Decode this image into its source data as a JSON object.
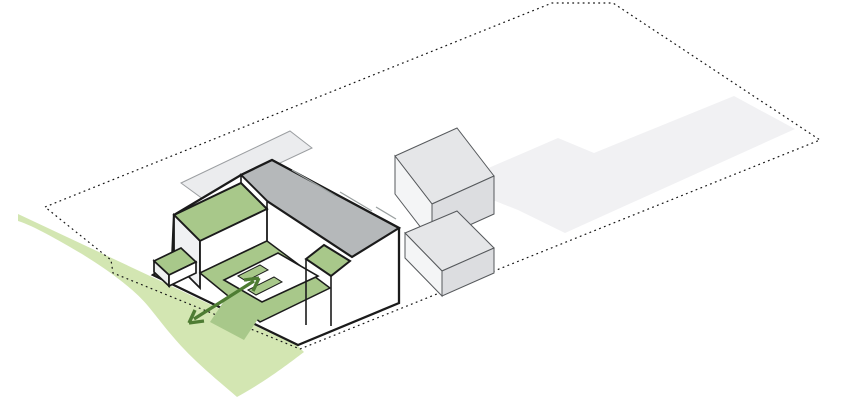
{
  "diagram": {
    "name": "architectural-site-axonometric-diagram",
    "canvas": {
      "width": 853,
      "height": 400
    },
    "palette": {
      "background": "#ffffff",
      "outline_heavy": "#1b1b1b",
      "outline_thin": "#56595c",
      "plate_fill": "#ebecee",
      "plate_stroke": "#9b9ea1",
      "ghost_fill": "#f1f1f3",
      "gray_roof": "#b5b8ba",
      "green_roof": "#a8c88a",
      "landscape_green": "#cfe4ab",
      "arrow_green": "#4e7c33",
      "wall_white": "#ffffff",
      "wall_shaded": "#f0f1f3"
    },
    "legend": {
      "site_boundary": "dotted property line",
      "ghost_future_footprint": "future phase footprint (flat light gray)",
      "green_roofs": "vegetated roofs and courtyard",
      "landscape_green": "landscape connection at south-west",
      "connection_arrow": "double-headed arrow linking courtyard and landscape"
    },
    "shapes": [
      {
        "name": "ground-plate",
        "points": [
          [
            181,
            183
          ],
          [
            290,
            131
          ],
          [
            312,
            148
          ],
          [
            203,
            199
          ]
        ],
        "fill": "#ebecee",
        "stroke": "#9b9ea1",
        "width": 1
      },
      {
        "name": "ghost-future-footprint",
        "points": [
          [
            470,
            176
          ],
          [
            558,
            138
          ],
          [
            594,
            153
          ],
          [
            734,
            96
          ],
          [
            795,
            129
          ],
          [
            565,
            233
          ],
          [
            518,
            210
          ],
          [
            470,
            191
          ]
        ],
        "fill": "#f1f1f3"
      },
      {
        "name": "landscape-green",
        "d": "M18,214 L150,276 L298,346 L304,352 C292,361 268,380 237,397 C222,384 200,366 184,349 C168,332 158,318 148,306 C134,289 108,270 82,254 C58,240 34,226 18,221 Z",
        "fill": "#cfe4ab",
        "opacity": 0.92
      },
      {
        "name": "site-boundary",
        "points": [
          [
            45,
            207
          ],
          [
            552,
            3
          ],
          [
            613,
            3
          ],
          [
            820,
            140
          ],
          [
            300,
            349
          ],
          [
            113,
            273
          ],
          [
            111,
            260
          ]
        ],
        "fill": "none",
        "stroke": "#161616",
        "width": 1.2,
        "dash": "1.8 3.4"
      },
      {
        "name": "annex-upper-top",
        "points": [
          [
            395,
            156
          ],
          [
            457,
            128
          ],
          [
            494,
            176
          ],
          [
            432,
            204
          ]
        ],
        "fill": "#e5e6e8",
        "stroke": "#56595c",
        "width": 1
      },
      {
        "name": "annex-upper-left-face",
        "points": [
          [
            395,
            156
          ],
          [
            432,
            204
          ],
          [
            432,
            242
          ],
          [
            395,
            194
          ]
        ],
        "fill": "#f4f5f6",
        "stroke": "#56595c",
        "width": 1
      },
      {
        "name": "annex-upper-front-face",
        "points": [
          [
            432,
            204
          ],
          [
            494,
            176
          ],
          [
            494,
            214
          ],
          [
            432,
            242
          ]
        ],
        "fill": "#dcdde0",
        "stroke": "#56595c",
        "width": 1
      },
      {
        "name": "annex-lower-top",
        "points": [
          [
            405,
            233
          ],
          [
            457,
            211
          ],
          [
            494,
            248
          ],
          [
            442,
            271
          ]
        ],
        "fill": "#e5e6e8",
        "stroke": "#56595c",
        "width": 1
      },
      {
        "name": "annex-lower-left-face",
        "points": [
          [
            405,
            233
          ],
          [
            442,
            271
          ],
          [
            442,
            296
          ],
          [
            405,
            258
          ]
        ],
        "fill": "#f4f5f6",
        "stroke": "#56595c",
        "width": 1
      },
      {
        "name": "annex-lower-front-face",
        "points": [
          [
            442,
            271
          ],
          [
            494,
            248
          ],
          [
            494,
            273
          ],
          [
            442,
            296
          ]
        ],
        "fill": "#dcdde0",
        "stroke": "#56595c",
        "width": 1
      },
      {
        "name": "building-silhouette",
        "points": [
          [
            174,
            215
          ],
          [
            241,
            175
          ],
          [
            272,
            160
          ],
          [
            399,
            228
          ],
          [
            399,
            303
          ],
          [
            298,
            345
          ],
          [
            153,
            275
          ],
          [
            172,
            262
          ]
        ],
        "fill": "#ffffff",
        "stroke": "#1b1b1b",
        "width": 2.3
      },
      {
        "name": "gray-bar-roof",
        "points": [
          [
            241,
            175
          ],
          [
            272,
            160
          ],
          [
            399,
            228
          ],
          [
            352,
            257
          ],
          [
            267,
            201
          ]
        ],
        "fill": "#b5b8ba",
        "stroke": "#1b1b1b",
        "width": 2.2
      },
      {
        "name": "bar-end-wall-strip",
        "points": [
          [
            241,
            175
          ],
          [
            267,
            201
          ],
          [
            267,
            209
          ],
          [
            241,
            183
          ]
        ],
        "fill": "#ffffff",
        "stroke": "#1b1b1b",
        "width": 1.6
      },
      {
        "name": "left-wing-green-roof",
        "points": [
          [
            174,
            215
          ],
          [
            241,
            183
          ],
          [
            267,
            209
          ],
          [
            200,
            241
          ]
        ],
        "fill": "#a8c88a",
        "stroke": "#1b1b1b",
        "width": 2
      },
      {
        "name": "left-wing-west-face",
        "points": [
          [
            174,
            215
          ],
          [
            200,
            241
          ],
          [
            200,
            288
          ],
          [
            174,
            262
          ]
        ],
        "fill": "#f0f1f3",
        "stroke": "#1b1b1b",
        "width": 1.8
      },
      {
        "name": "left-wing-se-face",
        "points": [
          [
            200,
            241
          ],
          [
            267,
            209
          ],
          [
            267,
            241
          ],
          [
            200,
            273
          ]
        ],
        "fill": "#ffffff",
        "stroke": "#1b1b1b",
        "width": 1.8
      },
      {
        "name": "courtyard-green-floor",
        "points": [
          [
            200,
            273
          ],
          [
            267,
            241
          ],
          [
            330,
            288
          ],
          [
            260,
            322
          ]
        ],
        "fill": "#a8c88a",
        "stroke": "#1b1b1b",
        "width": 1.5
      },
      {
        "name": "courtyard-gap-strip",
        "points": [
          [
            238,
            280
          ],
          [
            272,
            298
          ],
          [
            244,
            340
          ],
          [
            210,
            322
          ]
        ],
        "fill": "#a8c88a"
      },
      {
        "name": "courtyard-pavilion-roof",
        "points": [
          [
            224,
            280
          ],
          [
            278,
            253
          ],
          [
            318,
            276
          ],
          [
            262,
            302
          ]
        ],
        "fill": "#ffffff",
        "stroke": "#1b1b1b",
        "width": 1.6
      },
      {
        "name": "pavilion-slot-1",
        "points": [
          [
            238,
            276
          ],
          [
            260,
            265
          ],
          [
            268,
            270
          ],
          [
            246,
            281
          ]
        ],
        "fill": "#a8c88a",
        "stroke": "#1b1b1b",
        "width": 1
      },
      {
        "name": "pavilion-slot-2",
        "points": [
          [
            248,
            290
          ],
          [
            274,
            277
          ],
          [
            282,
            282
          ],
          [
            256,
            295
          ]
        ],
        "fill": "#a8c88a",
        "stroke": "#1b1b1b",
        "width": 1
      },
      {
        "name": "right-wing-green-roof",
        "points": [
          [
            306,
            259
          ],
          [
            324,
            245
          ],
          [
            350,
            261
          ],
          [
            331,
            276
          ]
        ],
        "fill": "#a8c88a",
        "stroke": "#1b1b1b",
        "width": 2
      },
      {
        "name": "step-edge-vertical-1",
        "d": "M306,259 L306,325",
        "fill": "none",
        "stroke": "#1b1b1b",
        "width": 1.6
      },
      {
        "name": "step-edge-vertical-2",
        "d": "M331,276 L331,326",
        "fill": "none",
        "stroke": "#1b1b1b",
        "width": 1.6
      },
      {
        "name": "entry-box-green-top",
        "points": [
          [
            154,
            261
          ],
          [
            181,
            248
          ],
          [
            196,
            262
          ],
          [
            169,
            275
          ]
        ],
        "fill": "#a8c88a",
        "stroke": "#1b1b1b",
        "width": 1.7
      },
      {
        "name": "entry-box-left-face",
        "points": [
          [
            154,
            261
          ],
          [
            169,
            275
          ],
          [
            169,
            286
          ],
          [
            154,
            272
          ]
        ],
        "fill": "#eef0f0",
        "stroke": "#1b1b1b",
        "width": 1.7
      },
      {
        "name": "entry-box-front-face",
        "points": [
          [
            169,
            275
          ],
          [
            196,
            262
          ],
          [
            196,
            273
          ],
          [
            169,
            286
          ]
        ],
        "fill": "#ffffff",
        "stroke": "#1b1b1b",
        "width": 1.7
      },
      {
        "name": "roof-parapet-line",
        "d": "M292,170 L336,196 M340,192 L372,211 M376,207 L396,219",
        "fill": "none",
        "stroke": "#9aa0a0",
        "width": 1.3
      },
      {
        "name": "connection-arrow",
        "d": "M254,281 L194,319 M259,278 L244,280 M259,278 L253,291 M189,323 L204,321 M189,323 L195,310",
        "fill": "none",
        "stroke": "#4e7c33",
        "width": 3.4
      }
    ]
  }
}
